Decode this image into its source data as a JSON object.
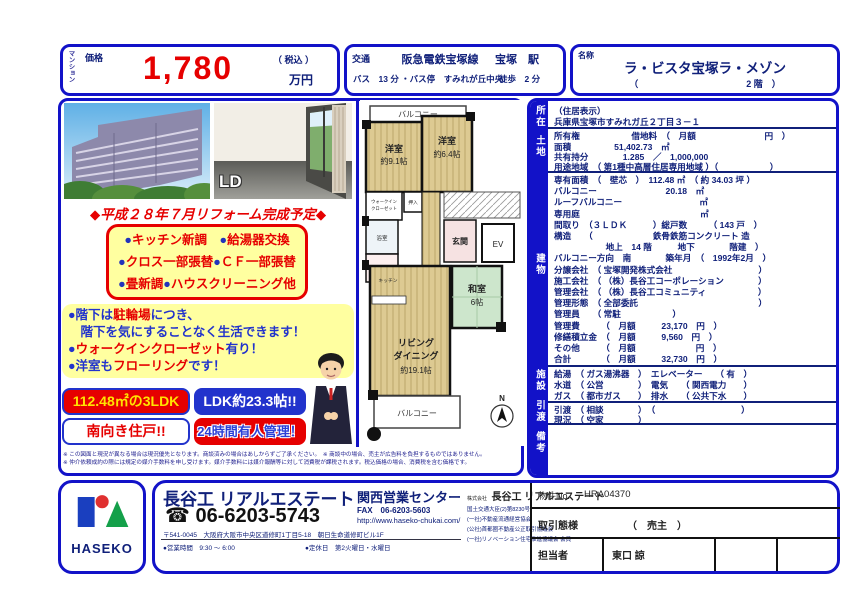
{
  "header": {
    "type_vertical": "マンション",
    "price_label": "価格",
    "price_value": "1,780",
    "price_tax": "（ 税込 ）",
    "price_unit": "万円",
    "transport_label": "交通",
    "rail_line": "阪急電鉄宝塚線",
    "bus": "バス　13 分 ・バス停　すみれが丘中央",
    "station": "宝塚　駅",
    "walk": "徒歩　2 分",
    "name_label": "名称",
    "name_value": "ラ・ビスタ宝塚ラ・メゾン",
    "name_floor": "（　　　　　　　　　　　　2 階　）"
  },
  "left": {
    "ld_label": "LD",
    "reform_banner": "◆平成２８年７月リフォーム完成予定◆",
    "bullet": "●",
    "reform_items": [
      [
        "キッチン新調　",
        "給湯器交換"
      ],
      [
        "クロス一部張替",
        "ＣＦ一部張替"
      ],
      [
        "畳新調",
        "ハウスクリーニング他"
      ]
    ],
    "features": [
      {
        "a": "●階下は",
        "b": "駐輪場",
        "c": "につき、"
      },
      {
        "a": "　階下を気にすることなく生活できます！",
        "b": "",
        "c": ""
      },
      {
        "a": "●",
        "b": "ウォークインクローゼット",
        "c": "有り！"
      },
      {
        "a": "●洋室も",
        "b": "フローリング",
        "c": "です！"
      }
    ],
    "badges": [
      "112.48㎡の3LDK",
      "LDK約23.3帖!!",
      "南向き住戸!!",
      "24時間有人管理！"
    ]
  },
  "floorplan": {
    "balcony_top": "バルコニー",
    "room1": "洋室",
    "room1_size": "約9.1帖",
    "room2": "洋室",
    "room2_size": "約6.4帖",
    "wic1": "ウォークイン",
    "wic2": "クローゼット",
    "oshiire": "押入",
    "bath": "浴室",
    "wash": "洗面",
    "genkan": "玄関",
    "ev": "EV",
    "washitsu": "和室",
    "washitsu_size": "6帖",
    "kitchen": "キッチン",
    "ld1": "リビング",
    "ld2": "ダイニング",
    "ld3": "約19.1帖",
    "balcony_bottom": "バルコニー",
    "compass": "N"
  },
  "table": {
    "labels": [
      "所在",
      "土地",
      "建物",
      "施設",
      "引渡",
      "備考"
    ],
    "shozai": [
      "（住居表示）",
      "兵庫県宝塚市すみれガ丘２丁目３－１"
    ],
    "tochi": [
      "所有権　　　　　　借地料　（　月額　　　　　　　　円　）",
      "面積　　　　　51,402.73　㎡",
      "共有持分　　　　1.285　／　1,000,000",
      "用途地域　（ 第1種中高層住居専用地域 ）（　　　　　　）"
    ],
    "tatemono": [
      "専有面積　（　壁芯　）　112.48 ㎡　（ 約 34.03 坪 ）",
      "バルコニー　　　　　　　　20.18　㎡",
      "ルーフバルコニー　　　　　　　　　㎡",
      "専用庭　　　　　　　　　　　　　　㎡",
      "間取り　（３ＬＤＫ　　　）総戸数　　　（ 143 戸　）",
      "構造　　（　　　　　　　鉄骨鉄筋コンクリート 造",
      "　　　　　　地上　14 階　　　地下　　　　階建　）",
      "バルコニー方向　南　　　　築年月　（　1992年2月　）",
      "分譲会社　（ 宝塚開発株式会社　　　　　　　　　　）",
      "施工会社　（ （株）長谷工コーポレーション　　　　）",
      "管理会社　（ （株）長谷工コミュニティ　　　　　　）",
      "管理形態　（ 全部委託　　　　　　　　　　　　　　）",
      "管理員　　（ 常駐　　　　　　）",
      "管理費　　　（　月額　　　23,170　円　）",
      "修繕積立金　（　月額　　　9,560　円　）",
      "その他　　　（　月額　　　　　　　円　）",
      "合計　　　　（　月額　　　32,730　円　）"
    ],
    "shisetsu": [
      "給湯　（ ガス湯沸器　）　エレベーター　　（ 有　）",
      "水道　（ 公営　　　　）　電気　　（ 関西電力　　）",
      "ガス　（ 都市ガス　　）　排水　　（ 公共下水　　）"
    ],
    "hikiwatashi": [
      "引渡　（ 相談　　　　）　（　　　　　　　　　　）",
      "現況　（ 空家　　　　）"
    ]
  },
  "fineprint": [
    "※ この図面と現況が異なる場合は現況優先となります。商談済みの場合はあしからずご了承ください。　※ 商談中の場合、売主が広告料を負担するものではありません。",
    "※ 仲介依頼成約の際には規定の媒介手数料を申し受けます。媒介手数料には媒介報酬等に対して消費税が課税されます。税込価格の場合、消費税を含む価格です。"
  ],
  "footer": {
    "logo_text": "HASEKO",
    "company": "長谷工 リアルエステート",
    "center": "関西営業センター",
    "tel_icon": "☎",
    "tel": "06-6203-5743",
    "fax": "FAX　06-6203-5603",
    "url": "http://www.haseko-chukai.com/",
    "address": "〒541-0045　大阪府大阪市中央区道修町1丁目5-18　朝日生命道修町ビル1F",
    "hours": "●営業時間　9:30 ～ 6:00",
    "holiday": "●定休日　第2火曜日・水曜日",
    "corp_small": "株式会社",
    "corp_big": "長谷工 リアルエステート",
    "licenses": [
      "国土交通大臣(2)第8230号",
      "(一社)不動産流通経営協会",
      "(公社)首都圏不動産公正取引協議会",
      "(一社)リノベーション住宅推進協議会 会員"
    ],
    "bukken_label": "物件No.",
    "bukken_no": "HRA04370",
    "torihiki_label": "取引態様",
    "torihiki_value": "（　売主　）",
    "tanto_label": "担当者",
    "tanto_value": "東口 諒"
  }
}
